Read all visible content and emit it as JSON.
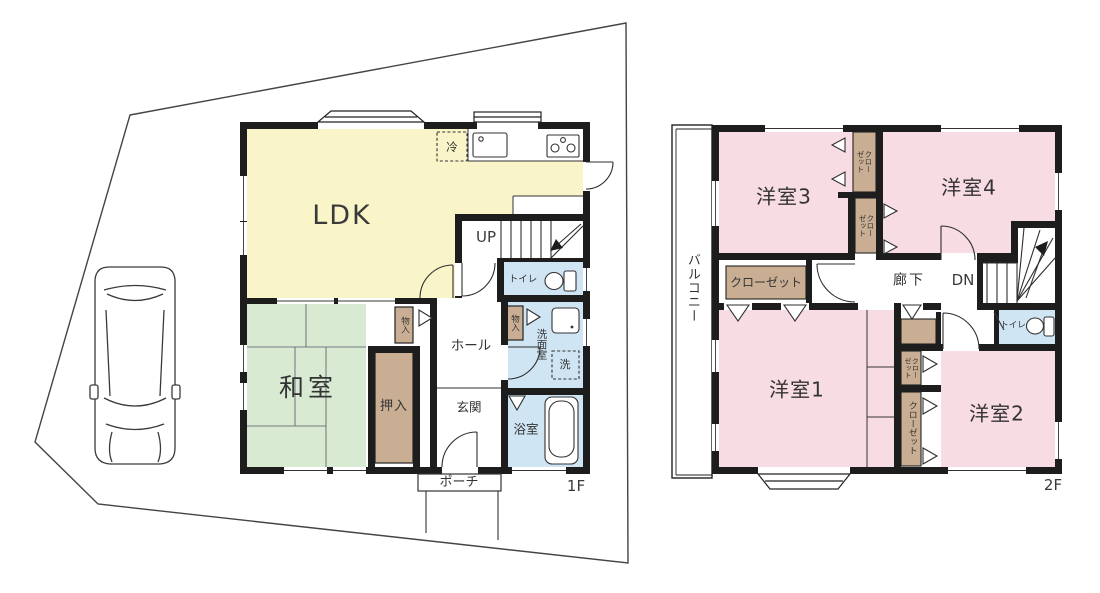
{
  "title": "間取り図",
  "colors": {
    "wall": "#1d1d1d",
    "outline": "#3a3a3a",
    "ldk": "#FAF5C8",
    "tatami": "#D8EAD2",
    "western": "#F8DCE4",
    "water": "#CFE5F3",
    "closet": "#C9AE93",
    "text": "#333333"
  },
  "floor1": {
    "label": "1F",
    "rooms": {
      "ldk": "LDK",
      "washitsu": "和室",
      "oshiire": "押入",
      "monoiri": "物入",
      "hall": "ホール",
      "genkan": "玄関",
      "porch": "ポーチ",
      "toilet": "トイレ",
      "senmen": "洗面室",
      "laundry": "洗",
      "fridge": "冷",
      "bath": "浴室"
    },
    "stairs": {
      "up": "UP"
    }
  },
  "floor2": {
    "label": "2F",
    "rooms": {
      "y1": "洋室1",
      "y2": "洋室2",
      "y3": "洋室3",
      "y4": "洋室4",
      "balcony": "バルコニー",
      "closet": "クローゼット",
      "corridor": "廊下",
      "toilet": "トイレ"
    },
    "stairs": {
      "dn": "DN"
    }
  }
}
